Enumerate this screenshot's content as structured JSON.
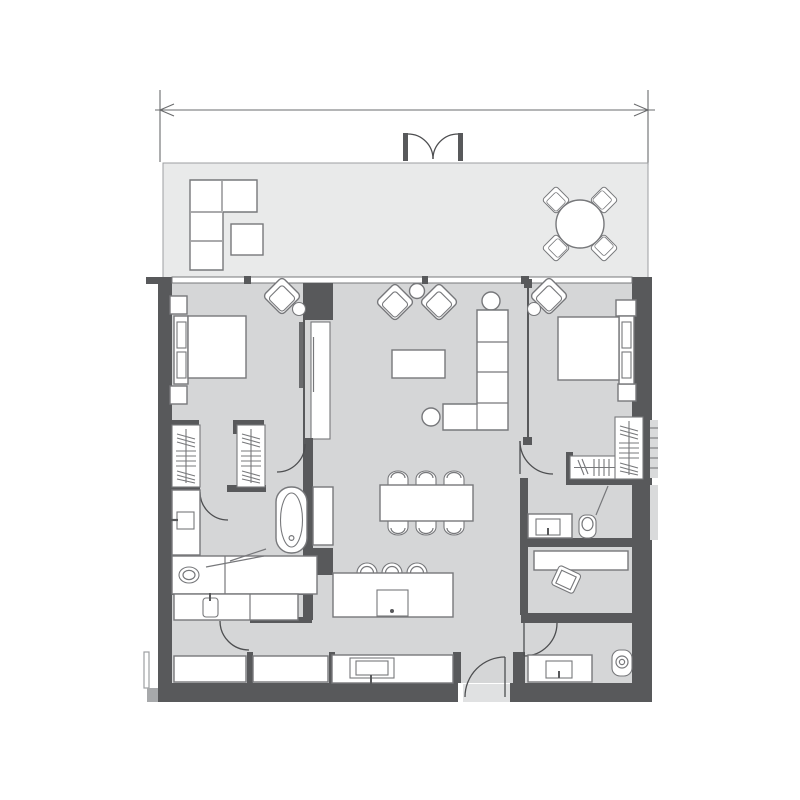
{
  "document": {
    "kind": "apartment-floor-plan",
    "text_labels": [],
    "dimension_line": {
      "labeled": false,
      "position": "top",
      "style": "double-arrow-with-extension-lines"
    }
  },
  "colors": {
    "bg": "#ffffff",
    "wall": "#58595b",
    "floor": "#d5d6d7",
    "balcony": "#e9eaea",
    "outline": "#77787b",
    "fixture": "#ffffff",
    "threshold": "#e0e1e2",
    "door": "#4d4e50"
  },
  "rooms": [
    {
      "name": "balcony",
      "symbols": [
        "l-shaped-sofa",
        "ottoman",
        "round-table",
        "four-outdoor-chairs",
        "double-french-door"
      ]
    },
    {
      "name": "bedroom-1",
      "symbols": [
        "double-bed",
        "headboard-cushions",
        "two-nightstands",
        "armchair",
        "round-side-table",
        "sliding-partition-tv-panel"
      ]
    },
    {
      "name": "walk-through-closet-1",
      "symbols": [
        "two-wardrobes-hanging-clothes",
        "door-swing"
      ]
    },
    {
      "name": "bathroom-1",
      "symbols": [
        "freestanding-bathtub",
        "wall-hung-toilet",
        "vanity-counter",
        "basin",
        "tall-cabinet",
        "door-swing"
      ]
    },
    {
      "name": "living-dining",
      "symbols": [
        "two-armchairs",
        "two-round-side-tables",
        "coffee-table",
        "l-shaped-sofa",
        "dining-table",
        "six-dining-chairs"
      ]
    },
    {
      "name": "kitchen",
      "symbols": [
        "island-with-sink",
        "three-bar-stools",
        "counter-with-cooktop"
      ]
    },
    {
      "name": "utility-room",
      "symbols": [
        "cabinet-rows",
        "small-wc-fixture",
        "door-swing"
      ]
    },
    {
      "name": "bedroom-2",
      "symbols": [
        "double-bed",
        "headboard-cushions",
        "two-nightstands",
        "armchair",
        "round-side-table",
        "glass-partition",
        "door-swing"
      ]
    },
    {
      "name": "closet-2",
      "symbols": [
        "two-wardrobes-hanging-clothes"
      ]
    },
    {
      "name": "bathroom-2",
      "symbols": [
        "vanity-basin",
        "toilet",
        "shower-screen"
      ]
    },
    {
      "name": "study-nook",
      "symbols": [
        "desk",
        "desk-chair"
      ]
    },
    {
      "name": "powder-room",
      "symbols": [
        "vanity-basin",
        "toilet",
        "door-swing"
      ]
    },
    {
      "name": "entry",
      "symbols": [
        "entry-door-swing",
        "threshold"
      ]
    }
  ]
}
